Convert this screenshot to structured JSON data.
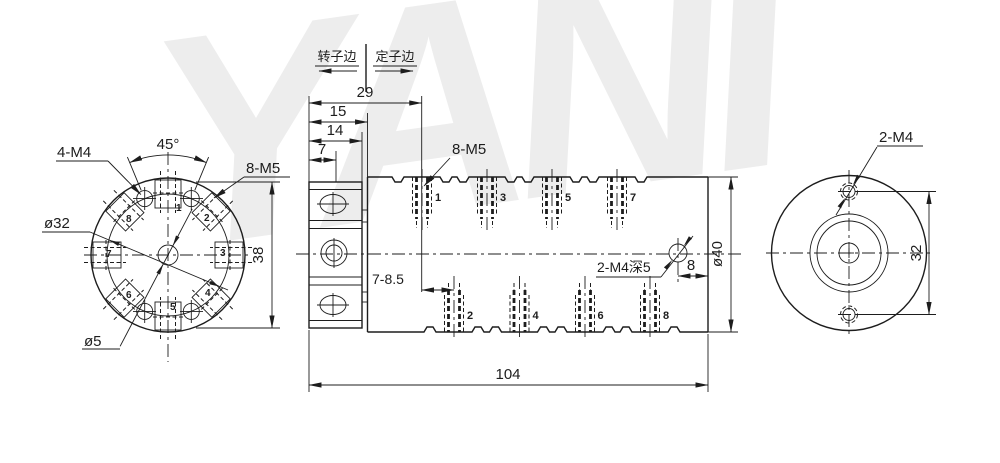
{
  "watermark": {
    "text": "YANI"
  },
  "header": {
    "rotor_side": "转子边",
    "stator_side": "定子边"
  },
  "left_view": {
    "label_4m4": "4-M4",
    "label_angle": "45°",
    "label_8m5": "8-M5",
    "label_d32": "ø32",
    "label_d5": "ø5",
    "dim_38": "38",
    "connector_numbers": [
      "1",
      "2",
      "3",
      "4",
      "5",
      "6",
      "7",
      "8"
    ]
  },
  "middle_view": {
    "dim_29": "29",
    "dim_15": "15",
    "dim_14": "14",
    "dim_7": "7",
    "dim_104": "104",
    "dim_pitch": "7-8.5",
    "dim_8": "8",
    "dim_d40": "ø40",
    "label_8m5": "8-M5",
    "label_2m4_deep": "2-M4深5",
    "top_rings": [
      "1",
      "3",
      "5",
      "7"
    ],
    "bottom_rings": [
      "2",
      "4",
      "6",
      "8"
    ]
  },
  "right_view": {
    "label_2m4": "2-M4",
    "dim_32": "32"
  },
  "colors": {
    "line": "#1d1d1d",
    "watermark": "#ededed",
    "background": "#ffffff"
  }
}
